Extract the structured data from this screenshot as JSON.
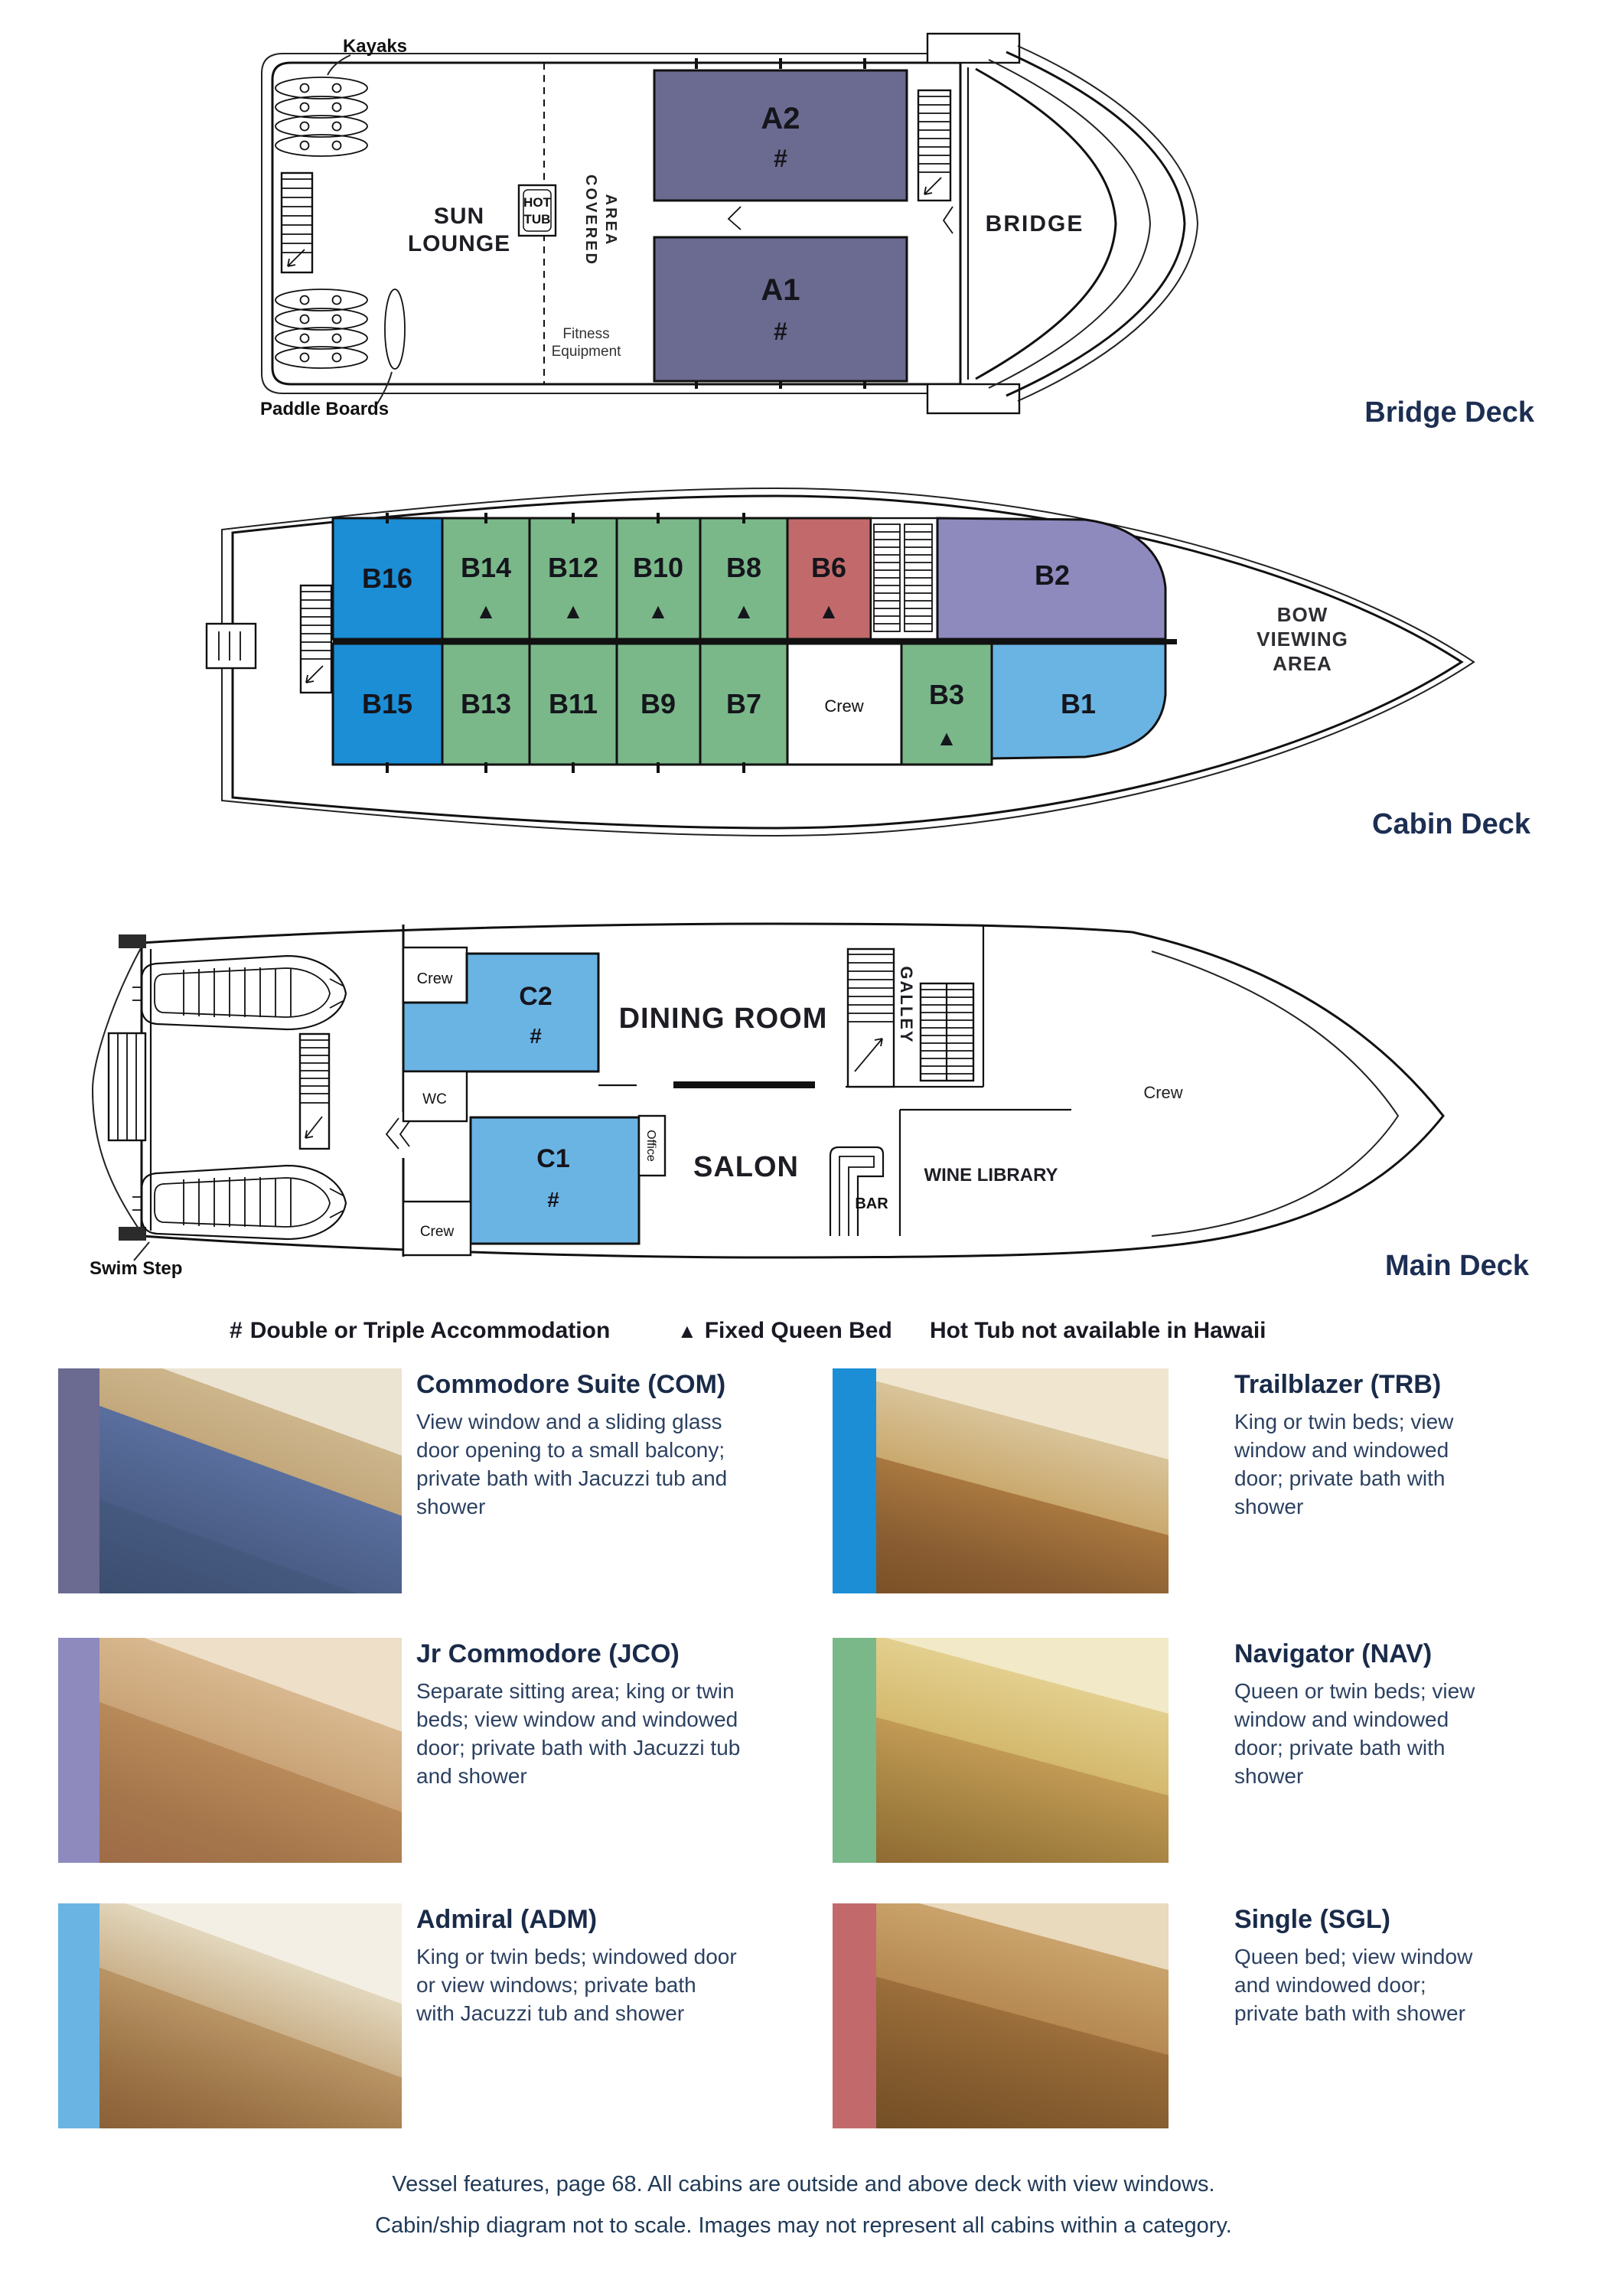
{
  "colors": {
    "dark_purple": "#6b6a90",
    "bright_blue": "#1b8ed6",
    "green": "#7ab88a",
    "red": "#c26a6b",
    "periwinkle": "#8e8abe",
    "light_blue": "#6ab4e4",
    "deck_label_text": "#1c2e52",
    "body_text": "#2c4161"
  },
  "decks": {
    "bridge": {
      "label": "Bridge Deck",
      "annotations": {
        "kayaks": "Kayaks",
        "paddle_boards": "Paddle Boards",
        "sun_1": "SUN",
        "sun_2": "LOUNGE",
        "hot_1": "HOT",
        "hot_2": "TUB",
        "covered_1": "COVERED",
        "covered_2": "AREA",
        "fitness_1": "Fitness",
        "fitness_2": "Equipment",
        "bridge": "BRIDGE"
      },
      "cabins": [
        {
          "id": "A2",
          "symbol": "#"
        },
        {
          "id": "A1",
          "symbol": "#"
        }
      ]
    },
    "cabin": {
      "label": "Cabin Deck",
      "annotations": {
        "bow_1": "BOW",
        "bow_2": "VIEWING",
        "bow_3": "AREA",
        "crew": "Crew"
      },
      "cabins_top": [
        {
          "id": "B16",
          "symbol": ""
        },
        {
          "id": "B14",
          "symbol": "▲"
        },
        {
          "id": "B12",
          "symbol": "▲"
        },
        {
          "id": "B10",
          "symbol": "▲"
        },
        {
          "id": "B8",
          "symbol": "▲"
        },
        {
          "id": "B6",
          "symbol": "▲"
        },
        {
          "id": "B2",
          "symbol": ""
        }
      ],
      "cabins_bottom": [
        {
          "id": "B15",
          "symbol": ""
        },
        {
          "id": "B13",
          "symbol": ""
        },
        {
          "id": "B11",
          "symbol": ""
        },
        {
          "id": "B9",
          "symbol": ""
        },
        {
          "id": "B7",
          "symbol": ""
        },
        {
          "id": "B3",
          "symbol": "▲"
        },
        {
          "id": "B1",
          "symbol": ""
        }
      ]
    },
    "main": {
      "label": "Main Deck",
      "annotations": {
        "crew_top": "Crew",
        "wc": "WC",
        "office": "Office",
        "dining": "DINING ROOM",
        "galley": "GALLEY",
        "crew_mid": "Crew",
        "crew_low": "Crew",
        "salon": "SALON",
        "bar": "BAR",
        "wine_library": "WINE LIBRARY",
        "swim_step": "Swim Step"
      },
      "cabins": [
        {
          "id": "C2",
          "symbol": "#"
        },
        {
          "id": "C1",
          "symbol": "#"
        }
      ]
    }
  },
  "legend": {
    "items": [
      {
        "symbol": "#",
        "label": "Double or Triple Accommodation"
      },
      {
        "symbol": "▲",
        "label": "Fixed Queen Bed"
      },
      {
        "symbol": "",
        "label": "Hot Tub not available in Hawaii"
      }
    ]
  },
  "categories": [
    {
      "code": "COM",
      "title": "Commodore Suite (COM)",
      "description": "View window and a sliding glass door opening to a small balcony; private bath with Jacuzzi tub and shower",
      "bar_color": "#6b6a90"
    },
    {
      "code": "TRB",
      "title": "Trailblazer (TRB)",
      "description": "King or twin beds; view window and windowed door; private bath with shower",
      "bar_color": "#1b8ed6"
    },
    {
      "code": "JCO",
      "title": "Jr Commodore (JCO)",
      "description": "Separate sitting area; king or twin beds; view window and windowed door; private bath with Jacuzzi tub and shower",
      "bar_color": "#8e8abe"
    },
    {
      "code": "NAV",
      "title": "Navigator (NAV)",
      "description": "Queen or twin beds; view window and windowed door; private bath with shower",
      "bar_color": "#7ab88a"
    },
    {
      "code": "ADM",
      "title": "Admiral (ADM)",
      "description": "King or twin beds; windowed door or view windows; private bath with Jacuzzi tub and shower",
      "bar_color": "#6ab4e4"
    },
    {
      "code": "SGL",
      "title": "Single (SGL)",
      "description": "Queen bed; view window and windowed door; private bath with shower",
      "bar_color": "#c26a6b"
    }
  ],
  "footer": {
    "line1": "Vessel features, page 68. All cabins are outside and above deck with view windows.",
    "line2": "Cabin/ship diagram not to scale. Images may not represent all cabins within a category."
  }
}
